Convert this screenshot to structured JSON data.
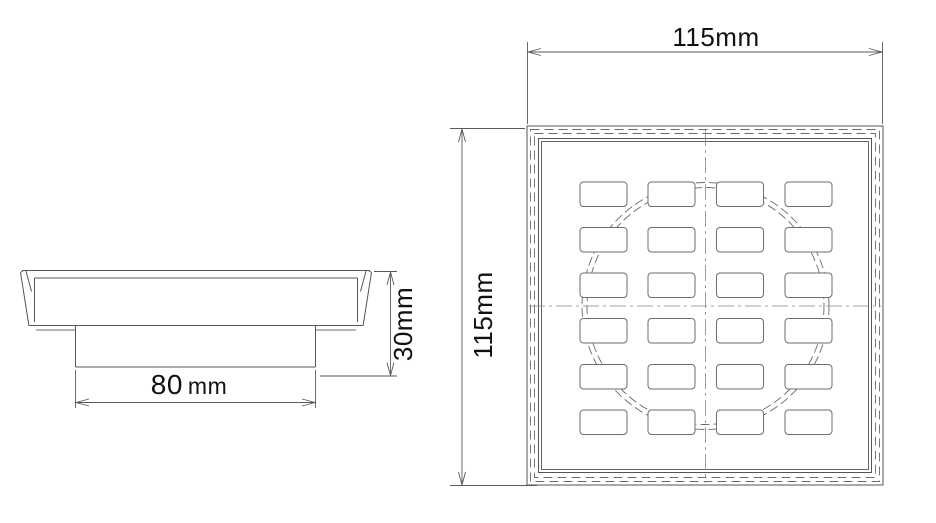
{
  "drawing": {
    "side_view": {
      "width_dim_value": "80",
      "width_dim_unit": "mm",
      "height_dim_label": "30mm"
    },
    "top_view": {
      "width_dim_label": "115mm",
      "height_dim_label": "115mm",
      "grate_slots": {
        "rows": 6,
        "columns": 4
      }
    },
    "colors": {
      "line": "#555555",
      "hidden_line": "#6a6a6a",
      "centerline": "#858585",
      "text": "#111111",
      "background": "#ffffff"
    }
  }
}
